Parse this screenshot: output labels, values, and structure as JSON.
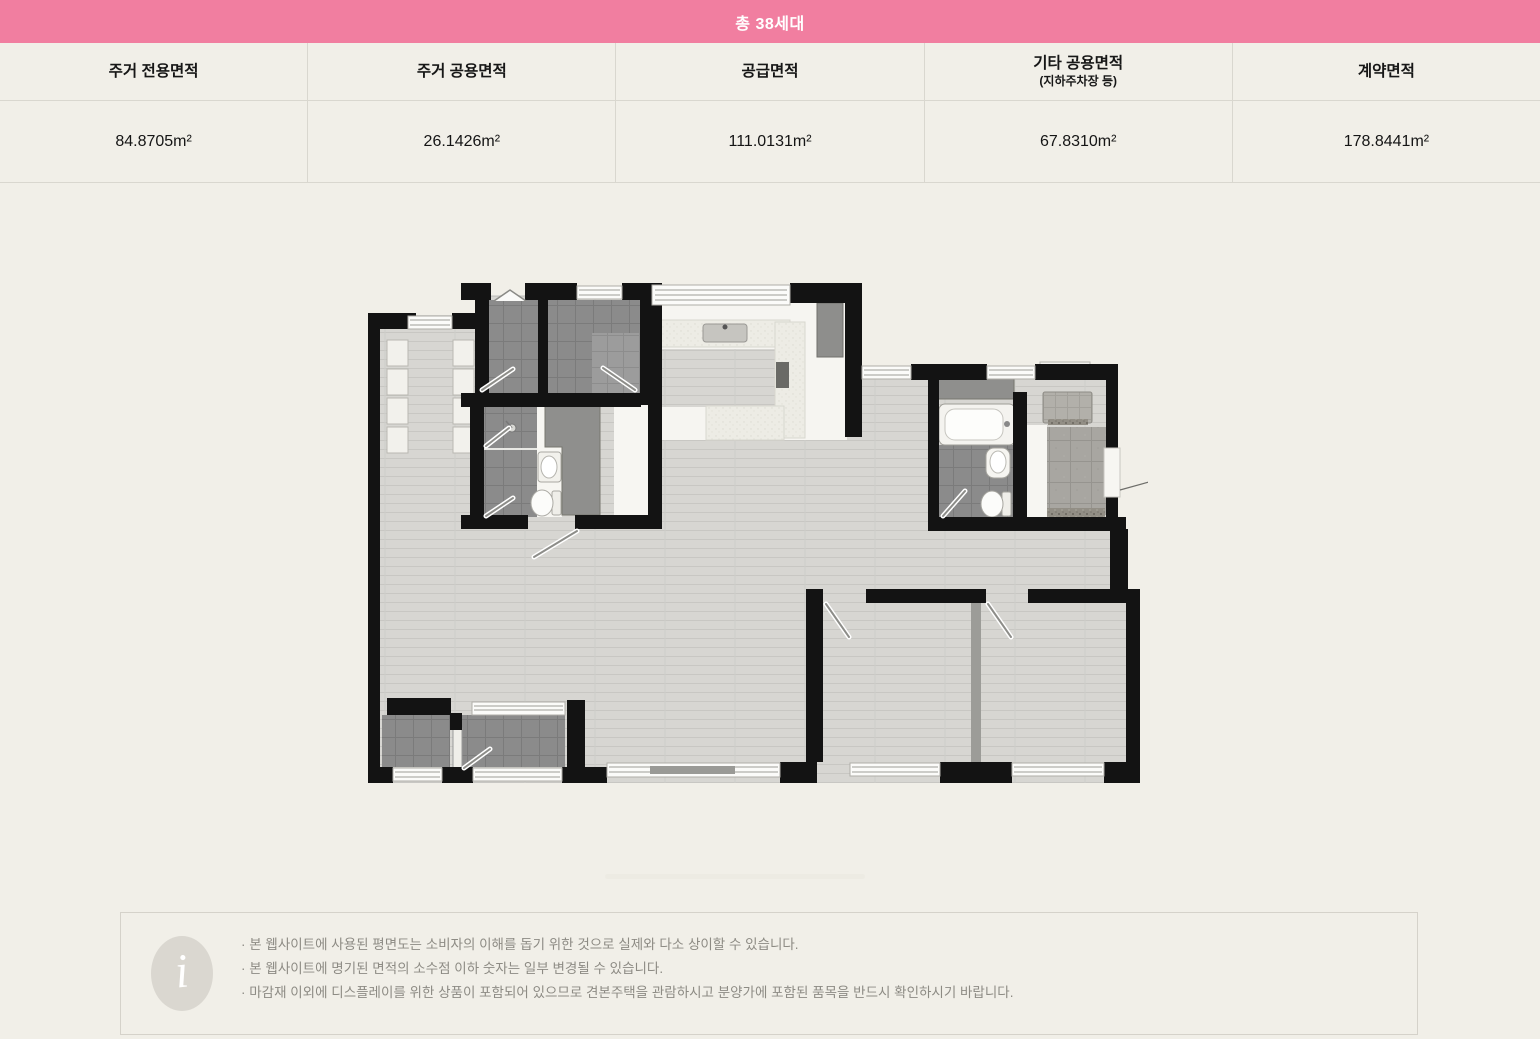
{
  "banner": {
    "label": "총 38세대"
  },
  "table": {
    "columns": [
      {
        "header": "주거 전용면적",
        "subheader": "",
        "value": "84.8705m²"
      },
      {
        "header": "주거 공용면적",
        "subheader": "",
        "value": "26.1426m²"
      },
      {
        "header": "공급면적",
        "subheader": "",
        "value": "111.0131m²"
      },
      {
        "header": "기타 공용면적",
        "subheader": "(지하주차장 등)",
        "value": "67.8310m²"
      },
      {
        "header": "계약면적",
        "subheader": "",
        "value": "178.8441m²"
      }
    ]
  },
  "notice": {
    "lines": [
      "· 본 웹사이트에 사용된 평면도는 소비자의 이해를 돕기 위한 것으로 실제와 다소 상이할 수 있습니다.",
      "· 본 웹사이트에 명기된 면적의 소수점 이하 숫자는 일부 변경될 수 있습니다.",
      "· 마감재 이외에 디스플레이를 위한 상품이 포함되어 있으므로 견본주택을 관람하시고 분양가에 포함된 품목을 반드시 확인하시기 바랍니다."
    ]
  },
  "colors": {
    "banner_pink": "#F17EA0",
    "page_bg": "#F1EFE8",
    "wall_black": "#131313",
    "tile_dark": "#8B8B8B",
    "wood_floor": "#D7D6D2",
    "notice_text": "#8D8B84",
    "table_border": "#D9D7CF"
  }
}
